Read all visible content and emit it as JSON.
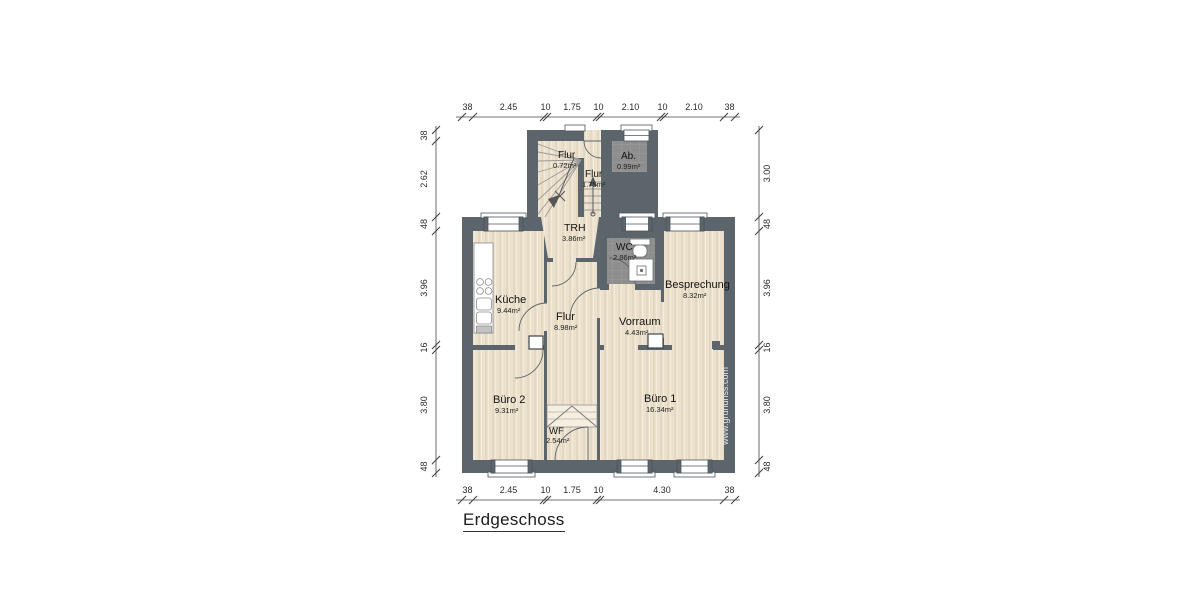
{
  "title": "Erdgeschoss",
  "watermark": "www.grundriss.com",
  "floor_plan": {
    "rooms": [
      {
        "id": "flur-top",
        "label": "Flur",
        "area": "0.72m²"
      },
      {
        "id": "flur-mid",
        "label": "Flur",
        "area": "1.75m²"
      },
      {
        "id": "ab",
        "label": "Ab.",
        "area": "0.99m²"
      },
      {
        "id": "trh",
        "label": "TRH",
        "area": "3.86m²"
      },
      {
        "id": "wc",
        "label": "WC",
        "area": "2.86m²"
      },
      {
        "id": "kueche",
        "label": "Küche",
        "area": "9.44m²"
      },
      {
        "id": "flur",
        "label": "Flur",
        "area": "8.98m²"
      },
      {
        "id": "vorraum",
        "label": "Vorraum",
        "area": "4.43m²"
      },
      {
        "id": "besprechung",
        "label": "Besprechung",
        "area": "8.32m²"
      },
      {
        "id": "buero2",
        "label": "Büro 2",
        "area": "9.31m²"
      },
      {
        "id": "buero1",
        "label": "Büro 1",
        "area": "16.34m²"
      },
      {
        "id": "wf",
        "label": "WF",
        "area": "2.54m²"
      }
    ],
    "dimensions": {
      "top": [
        "38",
        "2.45",
        "10",
        "1.75",
        "10",
        "2.10",
        "10",
        "2.10",
        "38"
      ],
      "bottom": [
        "38",
        "2.45",
        "10",
        "1.75",
        "10",
        "4.30",
        "38"
      ],
      "left": [
        "38",
        "2.62",
        "48",
        "3.96",
        "16",
        "3.80",
        "48"
      ],
      "right": [
        "3.00",
        "48",
        "3.96",
        "16",
        "3.80",
        "48"
      ]
    },
    "colors": {
      "wall": "#5c646c",
      "floor": "#ece1cd",
      "tile": "#8e8e8e"
    }
  }
}
